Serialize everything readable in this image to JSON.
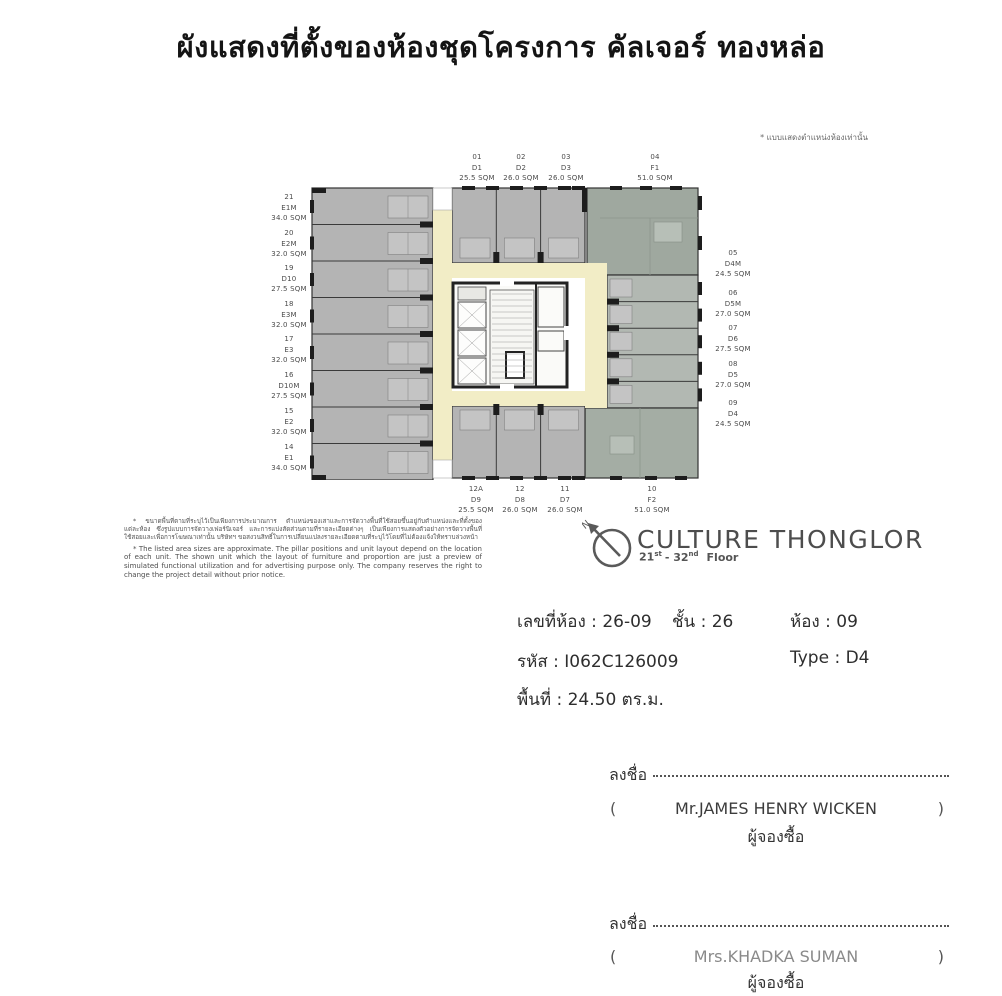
{
  "title": "ผังแสดงที่ตั้งของห้องชุดโครงการ คัลเจอร์ ทองหล่อ",
  "corner_note": "* แบบแสดงตำแหน่งห้องเท่านั้น",
  "plan": {
    "left_units": [
      {
        "no": "21",
        "type": "E1M",
        "area": "34.0 SQM"
      },
      {
        "no": "20",
        "type": "E2M",
        "area": "32.0 SQM"
      },
      {
        "no": "19",
        "type": "D10",
        "area": "27.5 SQM"
      },
      {
        "no": "18",
        "type": "E3M",
        "area": "32.0 SQM"
      },
      {
        "no": "17",
        "type": "E3",
        "area": "32.0 SQM"
      },
      {
        "no": "16",
        "type": "D10M",
        "area": "27.5 SQM"
      },
      {
        "no": "15",
        "type": "E2",
        "area": "32.0 SQM"
      },
      {
        "no": "14",
        "type": "E1",
        "area": "34.0 SQM"
      }
    ],
    "top_units": [
      {
        "no": "01",
        "type": "D1",
        "area": "25.5 SQM"
      },
      {
        "no": "02",
        "type": "D2",
        "area": "26.0 SQM"
      },
      {
        "no": "03",
        "type": "D3",
        "area": "26.0 SQM"
      },
      {
        "no": "04",
        "type": "F1",
        "area": "51.0 SQM"
      }
    ],
    "right_units": [
      {
        "no": "05",
        "type": "D4M",
        "area": "24.5 SQM"
      },
      {
        "no": "06",
        "type": "D5M",
        "area": "27.0 SQM"
      },
      {
        "no": "07",
        "type": "D6",
        "area": "27.5 SQM"
      },
      {
        "no": "08",
        "type": "D5",
        "area": "27.0 SQM"
      },
      {
        "no": "09",
        "type": "D4",
        "area": "24.5 SQM"
      }
    ],
    "bottom_units": [
      {
        "no": "12A",
        "type": "D9",
        "area": "25.5 SQM"
      },
      {
        "no": "12",
        "type": "D8",
        "area": "26.0 SQM"
      },
      {
        "no": "11",
        "type": "D7",
        "area": "26.0 SQM"
      },
      {
        "no": "10",
        "type": "F2",
        "area": "51.0 SQM"
      }
    ],
    "colors": {
      "unit_gray": "#b4b4b4",
      "unit_green_f1": "#9fa89f",
      "unit_green_f2": "#a4ada4",
      "right_wing": "#b2b8b2",
      "corridor": "#f2edc6",
      "core": "#fafaf8",
      "wall": "#2a2a2a"
    }
  },
  "disclaimer": {
    "thai": "* ขนาดพื้นที่ตามที่ระบุไว้เป็นเพียงการประมาณการ ตำแหน่งของเสาและการจัดวางพื้นที่ใช้สอยขึ้นอยู่กับตำแหน่งและที่ตั้งของแต่ละห้อง ซึ่งรูปแบบการจัดวางเฟอร์นิเจอร์ และการแบ่งสัดส่วนตามที่รายละเอียดต่างๆ เป็นเพียงการแสดงตัวอย่างการจัดวางพื้นที่ใช้สอยและเพื่อการโฆษณาเท่านั้น บริษัทฯ ขอสงวนสิทธิ์ในการเปลี่ยนแปลงรายละเอียดตามที่ระบุไว้โดยที่ไม่ต้องแจ้งให้ทราบล่วงหน้า",
    "english": "* The listed area sizes are approximate. The pillar positions and unit layout depend on the location of each unit. The shown unit which the layout of furniture and proportion are just a preview of simulated functional utilization and for advertising purpose only. The company reserves the right to change the project detail without prior notice."
  },
  "logo": {
    "name": "CULTURE THONGLOR",
    "floor": {
      "from": "21",
      "from_sup": "st",
      "mid": "- 32",
      "to_sup": "nd",
      "word": "Floor"
    },
    "north_letter": "N"
  },
  "details": {
    "separator": " : ",
    "room_line": {
      "label": "เลขที่ห้อง",
      "value": "26-09"
    },
    "floor_line": {
      "label": "ชั้น",
      "value": "26"
    },
    "unit_line": {
      "label": "ห้อง",
      "value": "09"
    },
    "code_line": {
      "label": "รหัส",
      "value": "I062C126009"
    },
    "type_line": {
      "label": "Type",
      "value": "D4"
    },
    "area_line": {
      "label": "พื้นที่",
      "value": "24.50 ตร.ม."
    }
  },
  "signatures": [
    {
      "sign_label": "ลงชื่อ",
      "open": "(",
      "name": "Mr.JAMES HENRY WICKEN",
      "close": ")",
      "role": "ผู้จองซื้อ"
    },
    {
      "sign_label": "ลงชื่อ",
      "open": "(",
      "name": "Mrs.KHADKA SUMAN",
      "close": ")",
      "role": "ผู้จองซื้อ"
    }
  ]
}
